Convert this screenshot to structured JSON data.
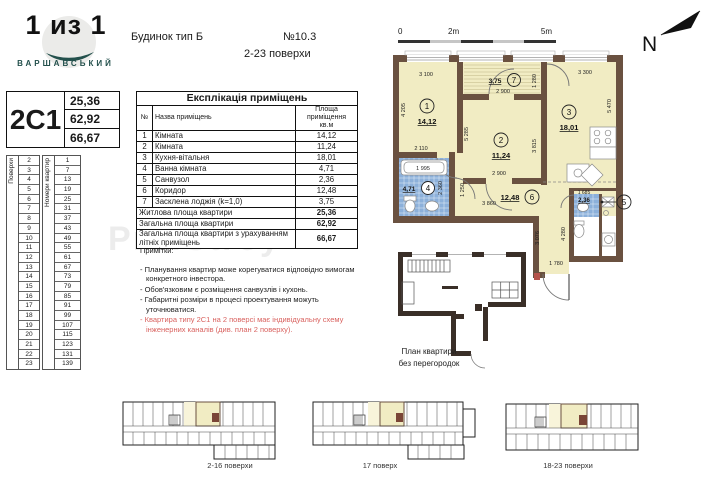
{
  "logo": {
    "title": "1 из 1",
    "subtitle": "ВАРШАВСЬКИЙ"
  },
  "header": {
    "building_type": "Будинок тип Б",
    "plan_number": "№10.3",
    "floors_range": "2-23  поверхи"
  },
  "apartment_card": {
    "code": "2С1",
    "living_area": "25,36",
    "total_area": "62,92",
    "total_area_summer": "66,67"
  },
  "floors_table": {
    "floors_label": "Поверхи",
    "apartments_label": "Номери квартир",
    "floors": [
      "2",
      "3",
      "4",
      "5",
      "6",
      "7",
      "8",
      "9",
      "10",
      "11",
      "12",
      "13",
      "14",
      "15",
      "16",
      "17",
      "18",
      "19",
      "20",
      "21",
      "22",
      "23"
    ],
    "apartments": [
      "1",
      "7",
      "13",
      "19",
      "25",
      "31",
      "37",
      "43",
      "49",
      "55",
      "61",
      "67",
      "73",
      "79",
      "85",
      "91",
      "99",
      "107",
      "115",
      "123",
      "131",
      "139"
    ]
  },
  "explication": {
    "title": "Експлікація приміщень",
    "col_num": "№",
    "col_name": "Назва приміщень",
    "col_area": "Площа приміщення кв.м",
    "rows": [
      [
        "1",
        "Кімната",
        "14,12"
      ],
      [
        "2",
        "Кімната",
        "11,24"
      ],
      [
        "3",
        "Кухня-вітальня",
        "18,01"
      ],
      [
        "4",
        "Ванна кімната",
        "4,71"
      ],
      [
        "5",
        "Санвузол",
        "2,36"
      ],
      [
        "6",
        "Коридор",
        "12,48"
      ],
      [
        "7",
        "Засклена лоджія (k=1,0)",
        "3,75"
      ]
    ],
    "summary": [
      [
        "Житлова площа квартири",
        "25,36"
      ],
      [
        "Загальна площа квартири",
        "62,92"
      ],
      [
        "Загальна площа квартири з урахуванням літніх приміщень",
        "66,67"
      ]
    ]
  },
  "notes": {
    "title": "Примітки:",
    "items": [
      "- Планування квартир може корегуватися відповідно вимогам конкретного інвестора.",
      "- Обов'язковим є розміщення санвузлів і кухонь.",
      "- Габаритні розміри в процесі проектування можуть уточнюватися."
    ],
    "highlight": "- Квартира типу 2С1 на 2 поверсі має індивідуальну схему інженерних каналів (див. план 2 поверху)."
  },
  "scale_bar": {
    "t0": "0",
    "t2": "2m",
    "t5": "5m"
  },
  "north_label": "N",
  "plan": {
    "rooms": [
      {
        "num": "1",
        "area": "14,12"
      },
      {
        "num": "2",
        "area": "11,24"
      },
      {
        "num": "3",
        "area": "18,01"
      },
      {
        "num": "4",
        "area": "4,71"
      },
      {
        "num": "5",
        "area": "2,36"
      },
      {
        "num": "6",
        "area": "12,48"
      },
      {
        "num": "7",
        "area": "3,75"
      }
    ],
    "dims": {
      "room1_top": "3 100",
      "room1_left": "4 205",
      "room1_bottom": "2 110",
      "loggia_width": "2 900",
      "loggia_depth": "1 280",
      "room2_left": "5 285",
      "room2_right": "3 815",
      "room2_door": "2 900",
      "room3_top": "3 300",
      "room3_right": "5 470",
      "bath_tub": "1 995",
      "bath_right": "2 360",
      "corr_height": "1 250",
      "corr_width": "3 860",
      "bath5_top": "1 685",
      "ext_right": "4 280",
      "ext_left": "3 076",
      "ext_bottom": "1 780"
    }
  },
  "outline_plan_label": {
    "line1": "План квартири",
    "line2": "без перегородок"
  },
  "mini_plans": [
    {
      "label": "2-16 поверхи"
    },
    {
      "label": "17 поверх"
    },
    {
      "label": "18-23 поверхи"
    }
  ],
  "watermark": "ProfStroy",
  "colors": {
    "room_fill": "#f1ecc3",
    "wall": "#6a5140",
    "tile": "#8cb0da",
    "accent_red": "#d9625f",
    "logo_teal": "#23504c"
  }
}
